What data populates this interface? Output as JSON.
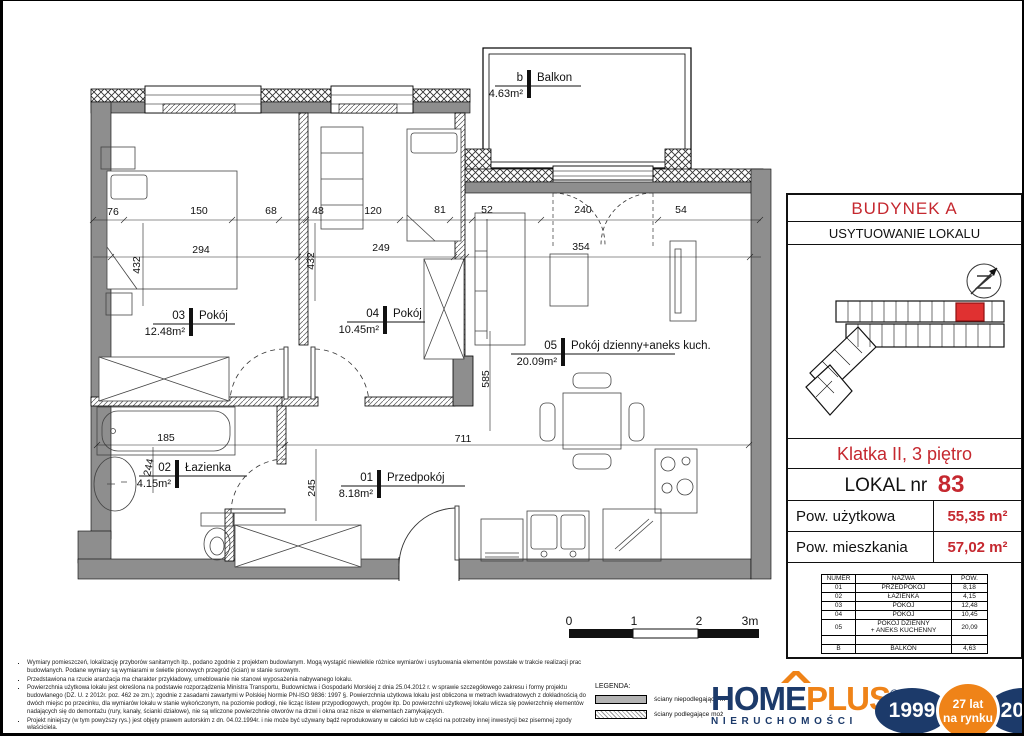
{
  "plan": {
    "room_labels": [
      {
        "num": "03",
        "name": "Pokój",
        "area": "12.48m²",
        "tick": [
          188,
          318
        ],
        "line": [
          150,
          232
        ]
      },
      {
        "num": "04",
        "name": "Pokój",
        "area": "10.45m²",
        "tick": [
          382,
          316
        ],
        "line": [
          344,
          422
        ]
      },
      {
        "num": "05",
        "name": "Pokój dzienny+aneks kuch.",
        "area": "20.09m²",
        "tick": [
          560,
          348
        ],
        "line": [
          508,
          672
        ]
      },
      {
        "num": "02",
        "name": "Łazienka",
        "area": "4.15m²",
        "tick": [
          174,
          470
        ],
        "line": [
          136,
          244
        ]
      },
      {
        "num": "01",
        "name": "Przedpokój",
        "area": "8.18m²",
        "tick": [
          376,
          480
        ],
        "line": [
          338,
          462
        ]
      },
      {
        "num": "b",
        "name": "Balkon",
        "area": "4.63m²",
        "tick": [
          526,
          80
        ],
        "line": [
          492,
          578
        ]
      }
    ],
    "dimensions": [
      {
        "t": "76",
        "x": 110,
        "y": 214
      },
      {
        "t": "150",
        "x": 196,
        "y": 213
      },
      {
        "t": "68",
        "x": 268,
        "y": 213
      },
      {
        "t": "48",
        "x": 315,
        "y": 213
      },
      {
        "t": "120",
        "x": 370,
        "y": 213
      },
      {
        "t": "81",
        "x": 437,
        "y": 212
      },
      {
        "t": "52",
        "x": 484,
        "y": 212
      },
      {
        "t": "240",
        "x": 580,
        "y": 212
      },
      {
        "t": "54",
        "x": 678,
        "y": 212
      },
      {
        "t": "294",
        "x": 198,
        "y": 252
      },
      {
        "t": "249",
        "x": 378,
        "y": 250
      },
      {
        "t": "354",
        "x": 578,
        "y": 249
      },
      {
        "t": "432",
        "x": 137,
        "y": 264,
        "r": -90
      },
      {
        "t": "432",
        "x": 311,
        "y": 260,
        "r": -90
      },
      {
        "t": "585",
        "x": 486,
        "y": 378,
        "r": -90
      },
      {
        "t": "185",
        "x": 163,
        "y": 440
      },
      {
        "t": "711",
        "x": 460,
        "y": 441
      },
      {
        "t": "244",
        "x": 149,
        "y": 467,
        "r": -78
      },
      {
        "t": "245",
        "x": 312,
        "y": 487,
        "r": -90
      }
    ],
    "scale_bar": {
      "labels": [
        "0",
        "1",
        "2",
        "3m"
      ],
      "xs": [
        566,
        631,
        696,
        747
      ],
      "y": 624
    }
  },
  "panel": {
    "building_title": "BUDYNEK A",
    "location_title": "USYTUOWANIE LOKALU",
    "floor_info": "Klatka II, 3 piętro",
    "lokal_label": "LOKAL nr",
    "lokal_number": "83",
    "area_rows": [
      {
        "label": "Pow. użytkowa",
        "value": "55,35 m²"
      },
      {
        "label": "Pow. mieszkania",
        "value": "57,02 m²"
      }
    ],
    "table": {
      "headers": [
        "NUMER",
        "NAZWA",
        "POW."
      ],
      "rows": [
        [
          "01",
          "PRZEDPOKÓJ",
          "8,18"
        ],
        [
          "02",
          "ŁAZIENKA",
          "4,15"
        ],
        [
          "03",
          "POKÓJ",
          "12,48"
        ],
        [
          "04",
          "POKÓJ",
          "10,45"
        ],
        [
          "05",
          "POKÓJ DZIENNY\n+ ANEKS KUCHENNY",
          "20,09"
        ],
        [
          "",
          "",
          ""
        ],
        [
          "B",
          "BALKON",
          "4,63"
        ]
      ]
    }
  },
  "footnotes": [
    "Wymiary pomieszczeń, lokalizację przyborów sanitarnych itp., podano zgodnie z projektem budowlanym. Mogą wystąpić niewielkie różnice wymiarów i usytuowania elementów powstałe w trakcie realizacji prac budowlanych. Podane wymiary są wymiarami w świetle pionowych przegród (ścian) w stanie surowym.",
    "Przedstawiona na rzucie aranżacja ma charakter przykładowy, umeblowanie nie stanowi wyposażenia nabywanego lokalu.",
    "Powierzchnia użytkowa lokalu jest określona na podstawie rozporządzenia Ministra Transportu, Budownictwa i Gospodarki Morskiej z dnia 25.04.2012 r. w sprawie szczegółowego zakresu i formy projektu budowlanego (DZ. U. z 2012r. poz. 462 ze zm.); zgodnie z zasadami zawartymi w Polskiej Normie PN-ISO 9836: 1997 §. Powierzchnia użytkowa lokalu jest obliczona w metrach kwadratowych z dokładnością do dwóch miejsc po przecinku, dla wymiarów lokalu w stanie wykończonym, na poziomie podłogi, nie licząc listew przypodłogowych, progów itp. Do powierzchni użytkowej lokalu wlicza się powierzchnię elementów nadających się do demontażu (rury, kanały, ścianki działowe), nie są wliczone powierzchnie otworów na drzwi i okna oraz nisze w elementach zamykających.",
    "Projekt niniejszy (w tym powyższy rys.) jest objęty prawem autorskim z dn. 04.02.1994r. i nie może być używany bądź reprodukowany w całości lub w części na potrzeby innej inwestycji bez pisemnej zgody właściciela."
  ],
  "legend": {
    "title": "LEGENDA:",
    "items": [
      {
        "label": "ściany niepodlegające m",
        "style": "solid"
      },
      {
        "label": "ściany podlegające moż",
        "style": "hatched"
      }
    ]
  },
  "logo": {
    "part1": "HOM",
    "part2": "E",
    "part3": "PLUS",
    "registered": "®",
    "subtitle": "NIERUCHOMOŚCI",
    "year_start": "1999",
    "badge_line1": "27 lat",
    "badge_line2": "na rynku",
    "year_end": "2026"
  },
  "colors": {
    "red": "#c5282f",
    "navy": "#1c3a6a",
    "orange": "#ef8318",
    "wall_gray": "#8e8e8e",
    "unit_red": "#e03131"
  }
}
